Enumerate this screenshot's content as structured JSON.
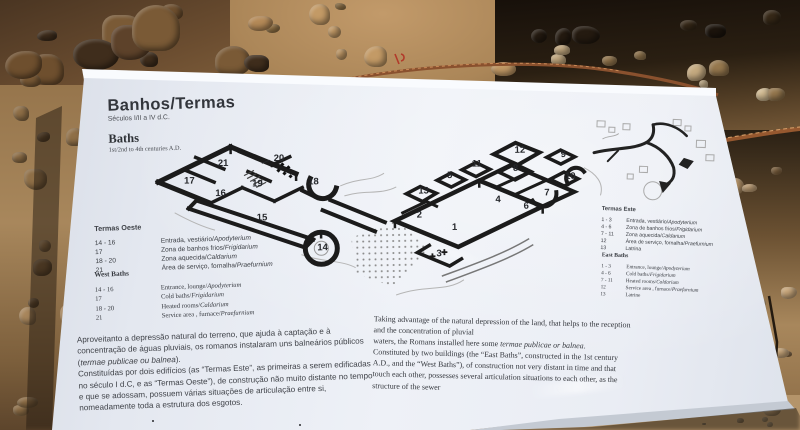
{
  "sign": {
    "title_pt": "Banhos/Termas",
    "subtitle_pt": "Séculos I/II a IV d.C.",
    "title_en": "Baths",
    "subtitle_en": "1st/2nd to 4th centuries A.D.",
    "legend_west_pt": {
      "heading": "Termas Oeste",
      "items": [
        {
          "range": "14 - 16",
          "label": "Entrada, vestiário/",
          "it": "Apodyterium"
        },
        {
          "range": "17",
          "label": "Zona de banhos frios/",
          "it": "Frigidarium"
        },
        {
          "range": "18 - 20",
          "label": "Zona aquecida/",
          "it": "Caldarium"
        },
        {
          "range": "21",
          "label": "Área de serviço, fornalha/",
          "it": "Praefurnium"
        }
      ]
    },
    "legend_west_en": {
      "heading": "West Baths",
      "items": [
        {
          "range": "14 - 16",
          "label": "Entrance, lounge/",
          "it": "Apodyterium"
        },
        {
          "range": "17",
          "label": "Cold baths/",
          "it": "Frigidarium"
        },
        {
          "range": "18 - 20",
          "label": "Heated rooms/",
          "it": "Caldarium"
        },
        {
          "range": "21",
          "label": "Service area , furnace/",
          "it": "Praefurnium"
        }
      ]
    },
    "legend_east_pt": {
      "heading": "Termas Este",
      "items": [
        {
          "range": "1 - 3",
          "label": "Entrada, vestiário/",
          "it": "Apodyterium"
        },
        {
          "range": "4 - 6",
          "label": "Zona de banhos frios/",
          "it": "Frigidarium"
        },
        {
          "range": "7 - 11",
          "label": "Zona aquecida/",
          "it": "Caldarium"
        },
        {
          "range": "12",
          "label": "Área de serviço, fornalha/",
          "it": "Praefurnium"
        },
        {
          "range": "13",
          "label": "Latrina",
          "it": ""
        }
      ]
    },
    "legend_east_en": {
      "heading": "East Baths",
      "items": [
        {
          "range": "1 - 3",
          "label": "Entrance, lounge/",
          "it": "Apodyterium"
        },
        {
          "range": "4 - 6",
          "label": "Cold baths/",
          "it": "Frigidarium"
        },
        {
          "range": "7 - 11",
          "label": "Heated rooms/",
          "it": "Caldarium"
        },
        {
          "range": "12",
          "label": "Service area , furnace/",
          "it": "Praefurnium"
        },
        {
          "range": "13",
          "label": "Latrine",
          "it": ""
        }
      ]
    },
    "paragraph_pt": [
      [
        {
          "t": "Aproveitanto a depressão natural do terreno, que ajuda à captação e à",
          "i": false
        }
      ],
      [
        {
          "t": "concentração de águas pluviais, os romanos instalaram uns balneários públicos",
          "i": false
        }
      ],
      [
        {
          "t": "(",
          "i": false
        },
        {
          "t": "termae publicae ou balnea",
          "i": true
        },
        {
          "t": ").",
          "i": false
        }
      ],
      [
        {
          "t": "Constituídas por dois edifícios (as “Termas Este”, as primeiras a serem edificadas",
          "i": false
        }
      ],
      [
        {
          "t": "no século I d.C, e as “Termas Oeste”), de construção não muito distante no tempo",
          "i": false
        }
      ],
      [
        {
          "t": "e que se adossam, possuem várias situações de articulação entre si,",
          "i": false
        }
      ],
      [
        {
          "t": "nomeadamente toda a estrutura dos esgotos.",
          "i": false
        }
      ]
    ],
    "paragraph_en": [
      [
        {
          "t": "Taking advantage of the natural depression of the land, that helps to the reception",
          "i": false
        }
      ],
      [
        {
          "t": "and the concentration of pluvial",
          "i": false
        }
      ],
      [
        {
          "t": "waters, the Romans installed here some ",
          "i": false
        },
        {
          "t": "termae publicae or balnea",
          "i": true
        },
        {
          "t": ".",
          "i": false
        }
      ],
      [
        {
          "t": "Constituted by two buildings (the “East Baths”, constructed in the 1st century",
          "i": false
        }
      ],
      [
        {
          "t": "A.D., and the “West Baths”), of construction not very distant in time and that",
          "i": false
        }
      ],
      [
        {
          "t": "touch each other, possesses several articulation situations to each other, as the",
          "i": false
        }
      ],
      [
        {
          "t": "structure of the sewer",
          "i": false
        }
      ]
    ],
    "plan": {
      "west_rooms": [
        {
          "n": "21",
          "x": 74,
          "y": 38
        },
        {
          "n": "17",
          "x": 40,
          "y": 55
        },
        {
          "n": "16",
          "x": 71,
          "y": 68
        },
        {
          "n": "19",
          "x": 108,
          "y": 59
        },
        {
          "n": "20",
          "x": 130,
          "y": 34
        },
        {
          "n": "18",
          "x": 164,
          "y": 58
        },
        {
          "n": "15",
          "x": 112,
          "y": 93
        },
        {
          "n": "14",
          "x": 172,
          "y": 124
        }
      ],
      "east_rooms": [
        {
          "n": "13",
          "x": 274,
          "y": 69
        },
        {
          "n": "5",
          "x": 303,
          "y": 54
        },
        {
          "n": "11",
          "x": 328,
          "y": 43
        },
        {
          "n": "12",
          "x": 371,
          "y": 30
        },
        {
          "n": "8",
          "x": 369,
          "y": 48
        },
        {
          "n": "9",
          "x": 417,
          "y": 35
        },
        {
          "n": "10",
          "x": 421,
          "y": 57
        },
        {
          "n": "7",
          "x": 400,
          "y": 73
        },
        {
          "n": "4",
          "x": 351,
          "y": 79
        },
        {
          "n": "6",
          "x": 379,
          "y": 86
        },
        {
          "n": "2",
          "x": 272,
          "y": 93
        },
        {
          "n": "1",
          "x": 307,
          "y": 106
        },
        {
          "n": "3",
          "x": 291,
          "y": 132
        }
      ]
    },
    "colors": {
      "sign_face": "#e9edf4",
      "sign_edge": "#f9fbfe",
      "print_text": "#3f4248",
      "plan_walls": "#1b1b1b",
      "ground_tan": "#a8875c",
      "rope_rust": "#96582f"
    }
  }
}
